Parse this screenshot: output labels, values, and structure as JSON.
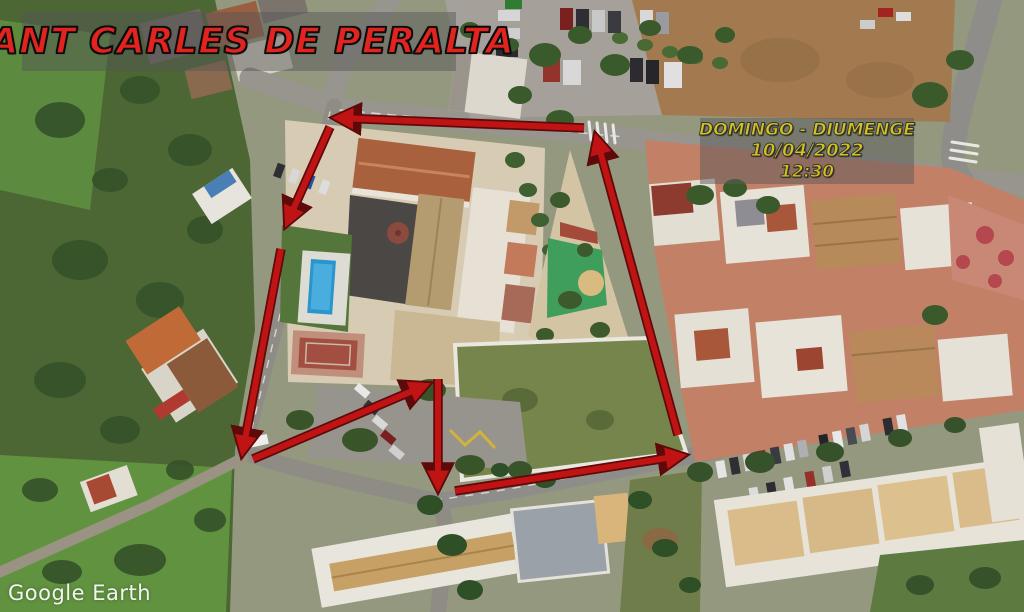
{
  "overlay": {
    "title": "SANT CARLES DE PERALTA",
    "title_color": "#e3231e",
    "schedule": {
      "line1": "DOMINGO - DIUMENGE",
      "line2": "10/04/2022",
      "line3": "12:30",
      "text_color": "#d4c21d"
    },
    "watermark": "Google Earth"
  },
  "route": {
    "color": "#c01414",
    "outline_color": "#5e0a0a",
    "arrows": [
      {
        "x1": 584,
        "y1": 128,
        "x2": 339,
        "y2": 118
      },
      {
        "x1": 330,
        "y1": 127,
        "x2": 288,
        "y2": 221
      },
      {
        "x1": 281,
        "y1": 249,
        "x2": 243,
        "y2": 450
      },
      {
        "x1": 253,
        "y1": 459,
        "x2": 424,
        "y2": 386
      },
      {
        "x1": 438,
        "y1": 379,
        "x2": 438,
        "y2": 485
      },
      {
        "x1": 455,
        "y1": 491,
        "x2": 680,
        "y2": 456
      },
      {
        "x1": 678,
        "y1": 435,
        "x2": 597,
        "y2": 140
      }
    ]
  }
}
